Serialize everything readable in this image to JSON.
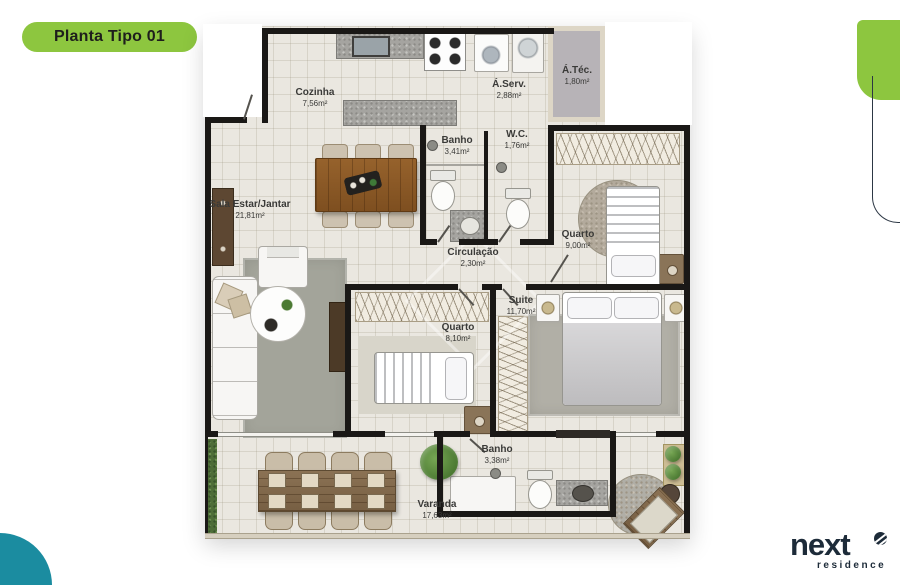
{
  "badge": {
    "label": "Planta Tipo 01"
  },
  "logo": {
    "brand": "next",
    "subtitle": "residence"
  },
  "rooms": {
    "cozinha": {
      "name": "Cozinha",
      "area": "7,56m²"
    },
    "aserv": {
      "name": "Á.Serv.",
      "area": "2,88m²"
    },
    "atec": {
      "name": "Á.Téc.",
      "area": "1,80m²"
    },
    "banho1": {
      "name": "Banho",
      "area": "3,41m²"
    },
    "wc": {
      "name": "W.C.",
      "area": "1,76m²"
    },
    "sala": {
      "name": "Sala Estar/Jantar",
      "area": "21,81m²"
    },
    "circulacao": {
      "name": "Circulação",
      "area": "2,30m²"
    },
    "quarto1": {
      "name": "Quarto",
      "area": "9,00m²"
    },
    "suite": {
      "name": "Suite",
      "area": "11,70m²"
    },
    "quarto2": {
      "name": "Quarto",
      "area": "8,10m²"
    },
    "banho2": {
      "name": "Banho",
      "area": "3,38m²"
    },
    "varanda": {
      "name": "Varanda",
      "area": "17,63m²"
    }
  },
  "colors": {
    "accent_green": "#8dc63f",
    "teal": "#1b8ca0",
    "logo_navy": "#1d2b39",
    "wall": "#1a1816",
    "floor": "#eae7e0",
    "atec_gray": "#b7b3b7"
  }
}
